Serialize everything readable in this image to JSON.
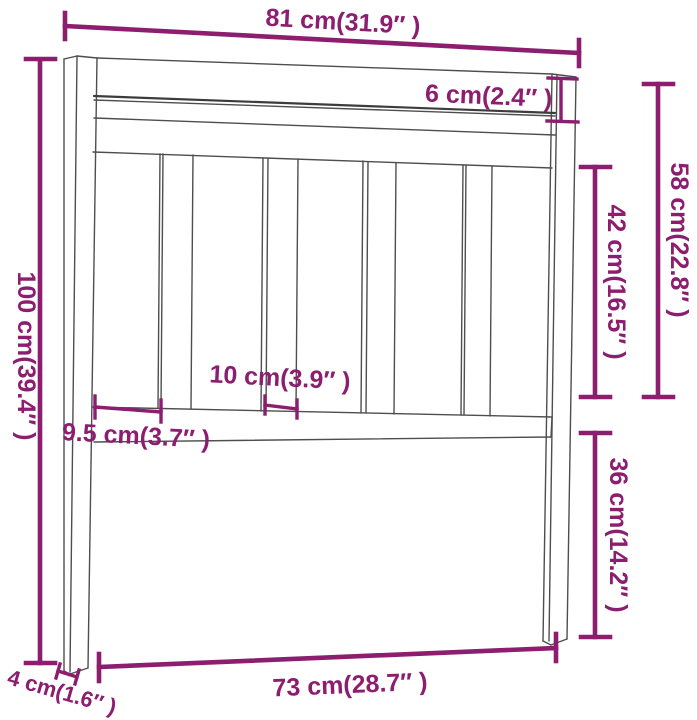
{
  "figure": {
    "kind": "furniture-dimension-diagram",
    "subject": "slatted bed headboard line drawing with dimension annotations",
    "accent_color": "#8c1d6f",
    "line_color": "#4e4e4e",
    "background_color": "#ffffff"
  },
  "dims": {
    "d81": {
      "id": "width-top",
      "label": "81 cm(31.9″ )"
    },
    "d6": {
      "id": "top-rail-height",
      "label": "6 cm(2.4″ )"
    },
    "d58": {
      "id": "upper-right-height",
      "label": "58 cm(22.8″ )"
    },
    "d42": {
      "id": "slat-section-height",
      "label": "42 cm(16.5″ )"
    },
    "d100": {
      "id": "total-height",
      "label": "100 cm(39.4″ )"
    },
    "d10": {
      "id": "slat-gap-width",
      "label": "10 cm(3.9″ )"
    },
    "d95": {
      "id": "slat-width",
      "label": "9.5 cm(3.7″ )"
    },
    "d36": {
      "id": "lower-right-height",
      "label": "36 cm(14.2″ )"
    },
    "d73": {
      "id": "width-bottom",
      "label": "73 cm(28.7″ )"
    },
    "d4": {
      "id": "leg-thickness",
      "label": "4 cm(1.6″ )"
    }
  }
}
